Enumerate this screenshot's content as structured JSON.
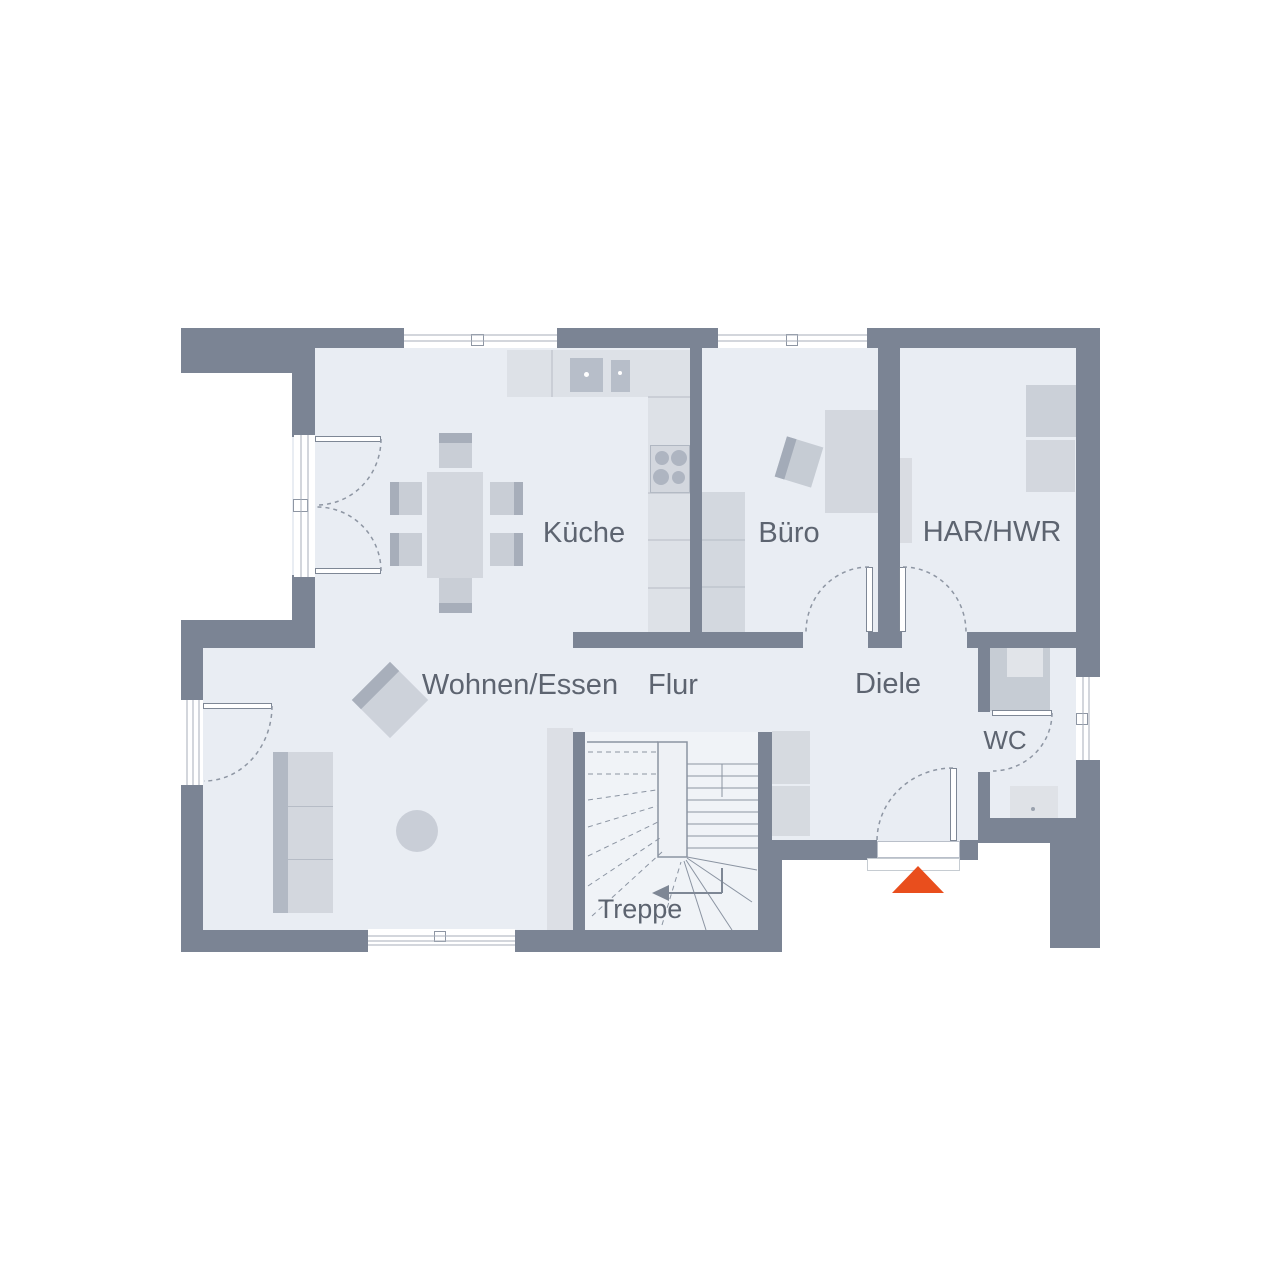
{
  "floorplan": {
    "title": "Erdgeschoss Grundriss",
    "rooms": {
      "kueche": {
        "label": "Küche"
      },
      "buero": {
        "label": "Büro"
      },
      "har_hwr": {
        "label": "HAR/HWR"
      },
      "wohnen": {
        "label": "Wohnen/Essen"
      },
      "flur": {
        "label": "Flur"
      },
      "diele": {
        "label": "Diele"
      },
      "wc": {
        "label": "WC"
      },
      "treppe": {
        "label": "Treppe"
      }
    },
    "colors": {
      "wall": "#7b8494",
      "floor": "#e9edf3",
      "furniture_light": "#d3d7de",
      "furniture_dark": "#a7aeba",
      "text": "#5d6470",
      "accent": "#e94e1d"
    },
    "entrance_marker": {
      "shape": "triangle",
      "color": "#e94e1d"
    }
  }
}
